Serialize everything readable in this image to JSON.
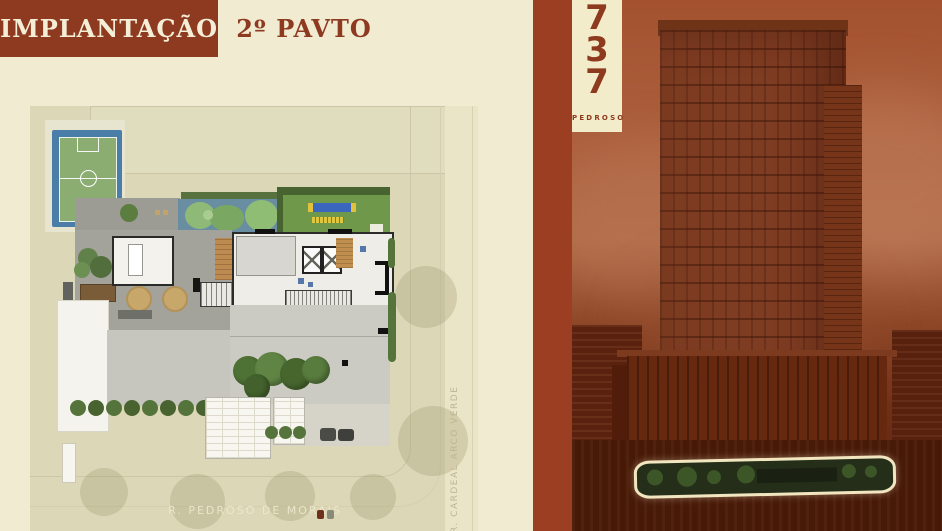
{
  "header": {
    "title": "IMPLANTAÇÃO",
    "floor_label": "2º PAVTO"
  },
  "logo": {
    "digit_1": "7",
    "digit_2": "3",
    "digit_3": "7",
    "name": "PEDROSO"
  },
  "site_plan": {
    "street_bottom": "R. PEDROSO DE MORAIS",
    "street_right": "R. CARDEAL ARCO VERDE",
    "features": [
      "basketball-court",
      "playground-pools",
      "lawn-with-benches",
      "lounge-terrace",
      "gourmet-kitchen",
      "elevator-core",
      "stairs",
      "tree-cluster",
      "hedges",
      "parking-cars"
    ]
  },
  "photo_panel": {
    "highlighted_floor": "2º pavimento highlight"
  },
  "colors": {
    "brand_red": "#8d3a20",
    "cream": "#f1ebd1",
    "court_blue": "#4b7da9",
    "court_green": "#8cad72",
    "lawn_green": "#70984a",
    "photo_tint": "#7e3c22",
    "highlight_outline": "#f2e6c0"
  }
}
